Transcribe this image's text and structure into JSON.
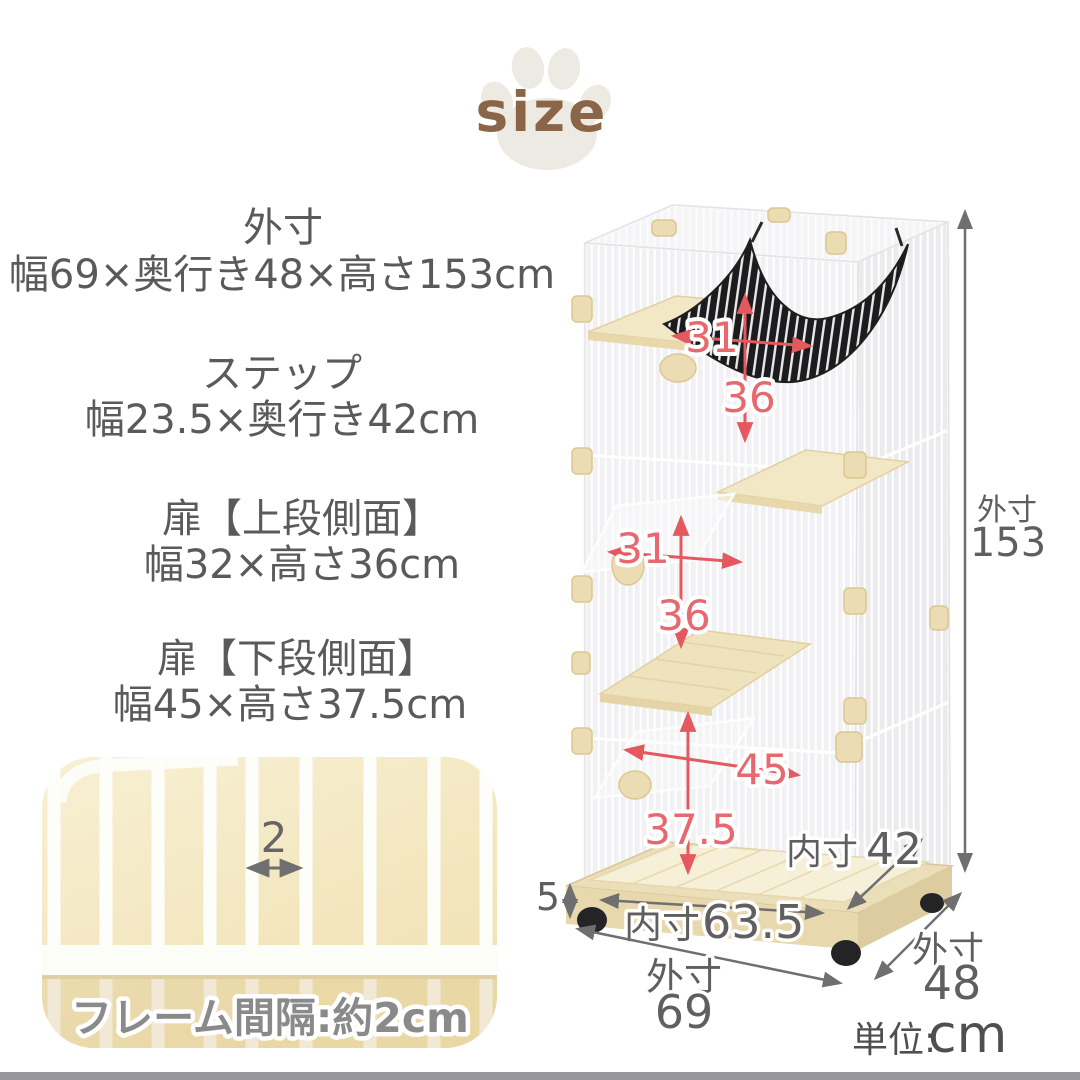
{
  "logo": {
    "title": "size"
  },
  "specs": [
    {
      "heading": "外寸",
      "detail": "幅69×奥行き48×高さ153cm"
    },
    {
      "heading": "ステップ",
      "detail": "幅23.5×奥行き42cm"
    },
    {
      "heading": "扉【上段側面】",
      "detail": "幅32×高さ36cm"
    },
    {
      "heading": "扉【下段側面】",
      "detail": "幅45×高さ37.5cm"
    }
  ],
  "frame_inset": {
    "gap_value": "2",
    "caption": "フレーム間隔:約2cm"
  },
  "dims": {
    "red": [
      {
        "name": "top-opening-width",
        "value": "31"
      },
      {
        "name": "top-opening-height",
        "value": "36"
      },
      {
        "name": "middle-opening-width",
        "value": "31"
      },
      {
        "name": "middle-opening-height",
        "value": "36"
      },
      {
        "name": "bottom-opening-width",
        "value": "45"
      },
      {
        "name": "bottom-opening-height",
        "value": "37.5"
      }
    ],
    "caster_height": "5",
    "inner_depth": {
      "label": "内寸",
      "value": "42"
    },
    "inner_width": {
      "label": "内寸",
      "value": "63.5"
    },
    "outer_width": {
      "label": "外寸",
      "value": "69"
    },
    "outer_depth": {
      "label": "外寸",
      "value": "48"
    },
    "outer_height": {
      "label": "外寸",
      "value": "153"
    }
  },
  "unit": {
    "label": "単位:",
    "value": "cm"
  },
  "colors": {
    "accent_red": "#e4595f",
    "label_grey": "#5f5f5f",
    "logo_brown": "#8a6547",
    "base_beige": "#ebdfba",
    "shelf_cream": "#f3e8c6",
    "inset_cream": "#f6ecca"
  }
}
